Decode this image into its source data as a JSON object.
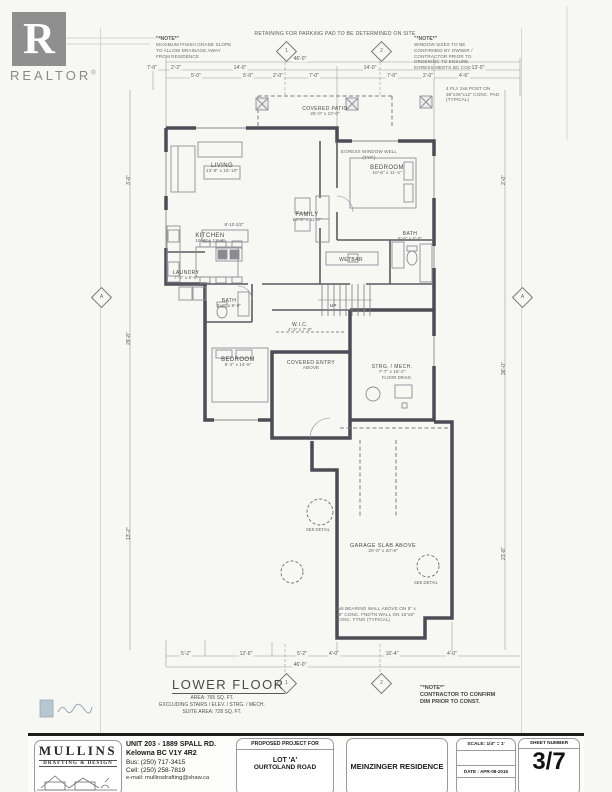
{
  "logo": {
    "word": "REALTOR",
    "reg": "®",
    "letter": "R"
  },
  "notes": {
    "retaining": "RETAINING FOR PARKING PAD TO BE DETERMINED ON SITE",
    "note_title": "\"*NOTE*\"",
    "left_body": "MAXIMUM FINISH GRADE SLOPE TO ALLOW DRAINAGE AWAY FROM RESIDENCE",
    "right_body": "WINDOW SIZES TO BE CONFIRMED BY OWNER / CONTRACTOR PRIOR TO ORDERING TO ENSURE EGRESS MEETS BC CODE",
    "post": "4 PLY 2x6 POST ON 36\"x36\"x12\" CONC. PAD (TYPICAL)",
    "window_well": "EGRESS WINDOW WELL (TYP.)",
    "bearing": "2x6 BEARING WALL ABOVE ON 8\" x 16\" CONC. FNDTN WALL ON 16\"x8\" CONC. FTNG (TYPICAL)",
    "contractor_title": "\"*NOTE*\"",
    "contractor_l1": "CONTRACTOR TO CONFIRM",
    "contractor_l2": "DIM PRIOR TO CONST."
  },
  "rooms": [
    {
      "name": "LIVING",
      "dims": "13'-8\" x 15'-10\""
    },
    {
      "name": "KITCHEN",
      "dims": "10'-6\" x 12'-8\""
    },
    {
      "name": "LAUNDRY",
      "dims": "7'-2\" x 5'-0\""
    },
    {
      "name": "BATH",
      "dims": "5'-0\" x 8'-0\""
    },
    {
      "name": "FAMILY",
      "dims": "14'-2\" x 11'-0\""
    },
    {
      "name": "BEDROOM",
      "dims": "10'-6\" x 11'-4\""
    },
    {
      "name": "BATH",
      "dims": "8'-6\" x 5'-0\""
    },
    {
      "name": "WETBAR",
      "dims": ""
    },
    {
      "name": "W.I.C.",
      "dims": "4'-2\" x 7'-0\""
    },
    {
      "name": "BEDROOM",
      "dims": "9'-2\" x 14'-6\""
    },
    {
      "name": "STRG. / MECH.",
      "dims": "7'-7\" x 16'-2\""
    },
    {
      "name": "COVERED ENTRY",
      "dims": "ABOVE"
    },
    {
      "name": "COVERED PATIO",
      "dims": "26'-0\" x 10'-0\""
    },
    {
      "name": "GARAGE SLAB ABOVE",
      "dims": "20'-8\" x 20'-8\""
    }
  ],
  "labels": {
    "up": "UP",
    "floor_drain": "FLOOR DRAIN",
    "see_detail": "SEE DETAIL",
    "kitchen_run": "8'-10 1/2\""
  },
  "dims": {
    "overall_top": "46'-0\"",
    "top_row1": [
      "7'-0\"",
      "2'-2\"",
      "14'-0\"",
      "14'-0\"",
      "13'-0\""
    ],
    "top_row2": [
      "5'-0\"",
      "5'-0\"",
      "2'-0\"",
      "7'-0\"",
      "7'-0\"",
      "2'-0\"",
      "4'-6\""
    ],
    "bottom_row": [
      "5'-2\"",
      "12'-6\"",
      "5'-2\"",
      "4'-0\"",
      "16'-4\"",
      "4'-0\""
    ],
    "overall_bottom": "46'-0\"",
    "left": [
      "3'-6\"",
      "29'-8\"",
      "13'-2\""
    ],
    "right": [
      "2'-0\"",
      "36'-0\"",
      "21'-8\""
    ]
  },
  "markers": {
    "top1": "1",
    "top2": "2",
    "bottom1": "1",
    "bottom2": "2",
    "left": "A",
    "right": "A"
  },
  "floor_title": {
    "title": "LOWER FLOOR",
    "area_line": "AREA:   765 SQ. FT.",
    "excluding_line": "EXCLUDING STAIRS / ELEV. / STRG. / MECH.",
    "suite_line": "SUITE AREA:   728 SQ. FT."
  },
  "title_block": {
    "company": "MULLINS",
    "company_sub": "DRAFTING & DESIGN",
    "address1": "UNIT 203 - 1889 SPALL RD.",
    "address2": "Kelowna BC V1Y 4R2",
    "bus": "Bus: (250) 717-3415",
    "cell": "Cell: (250) 258-7819",
    "email": "e-mail: mullinsdrafting@shaw.ca",
    "project_for": "PROPOSED PROJECT FOR",
    "project1": "LOT 'A'",
    "project2": "OURTOLAND ROAD",
    "residence": "MEINZINGER RESIDENCE",
    "scale": "SCALE: 1/4\" = 1'",
    "date": "DATE : APR-08-2015",
    "sheet_label": "SHEET NUMBER",
    "sheet_number": "3/7"
  }
}
